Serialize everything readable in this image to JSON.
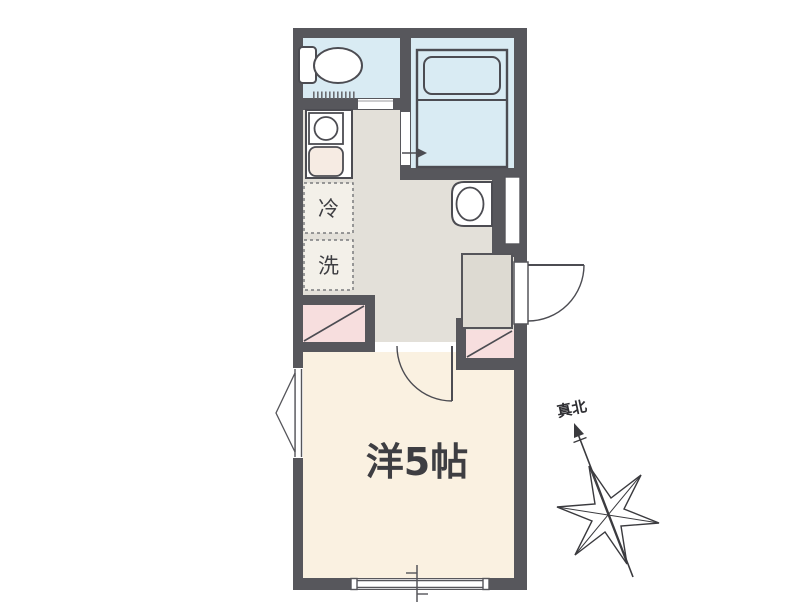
{
  "plan": {
    "labels": {
      "main_room": "洋5帖",
      "refrigerator": "冷",
      "washer": "洗",
      "true_north": "真北"
    },
    "colors": {
      "wall": "#57575c",
      "wet_room": "#d9ebf3",
      "hall": "#e3e0d9",
      "genkan": "#dddad2",
      "main_room": "#faf1e1",
      "closet": "#f7dede",
      "sink": "#f6ebe3",
      "appliance_box": "#f3f0e9",
      "fixture": "#ffffff",
      "line": "#4c4c52",
      "text": "#3e3e42"
    }
  }
}
